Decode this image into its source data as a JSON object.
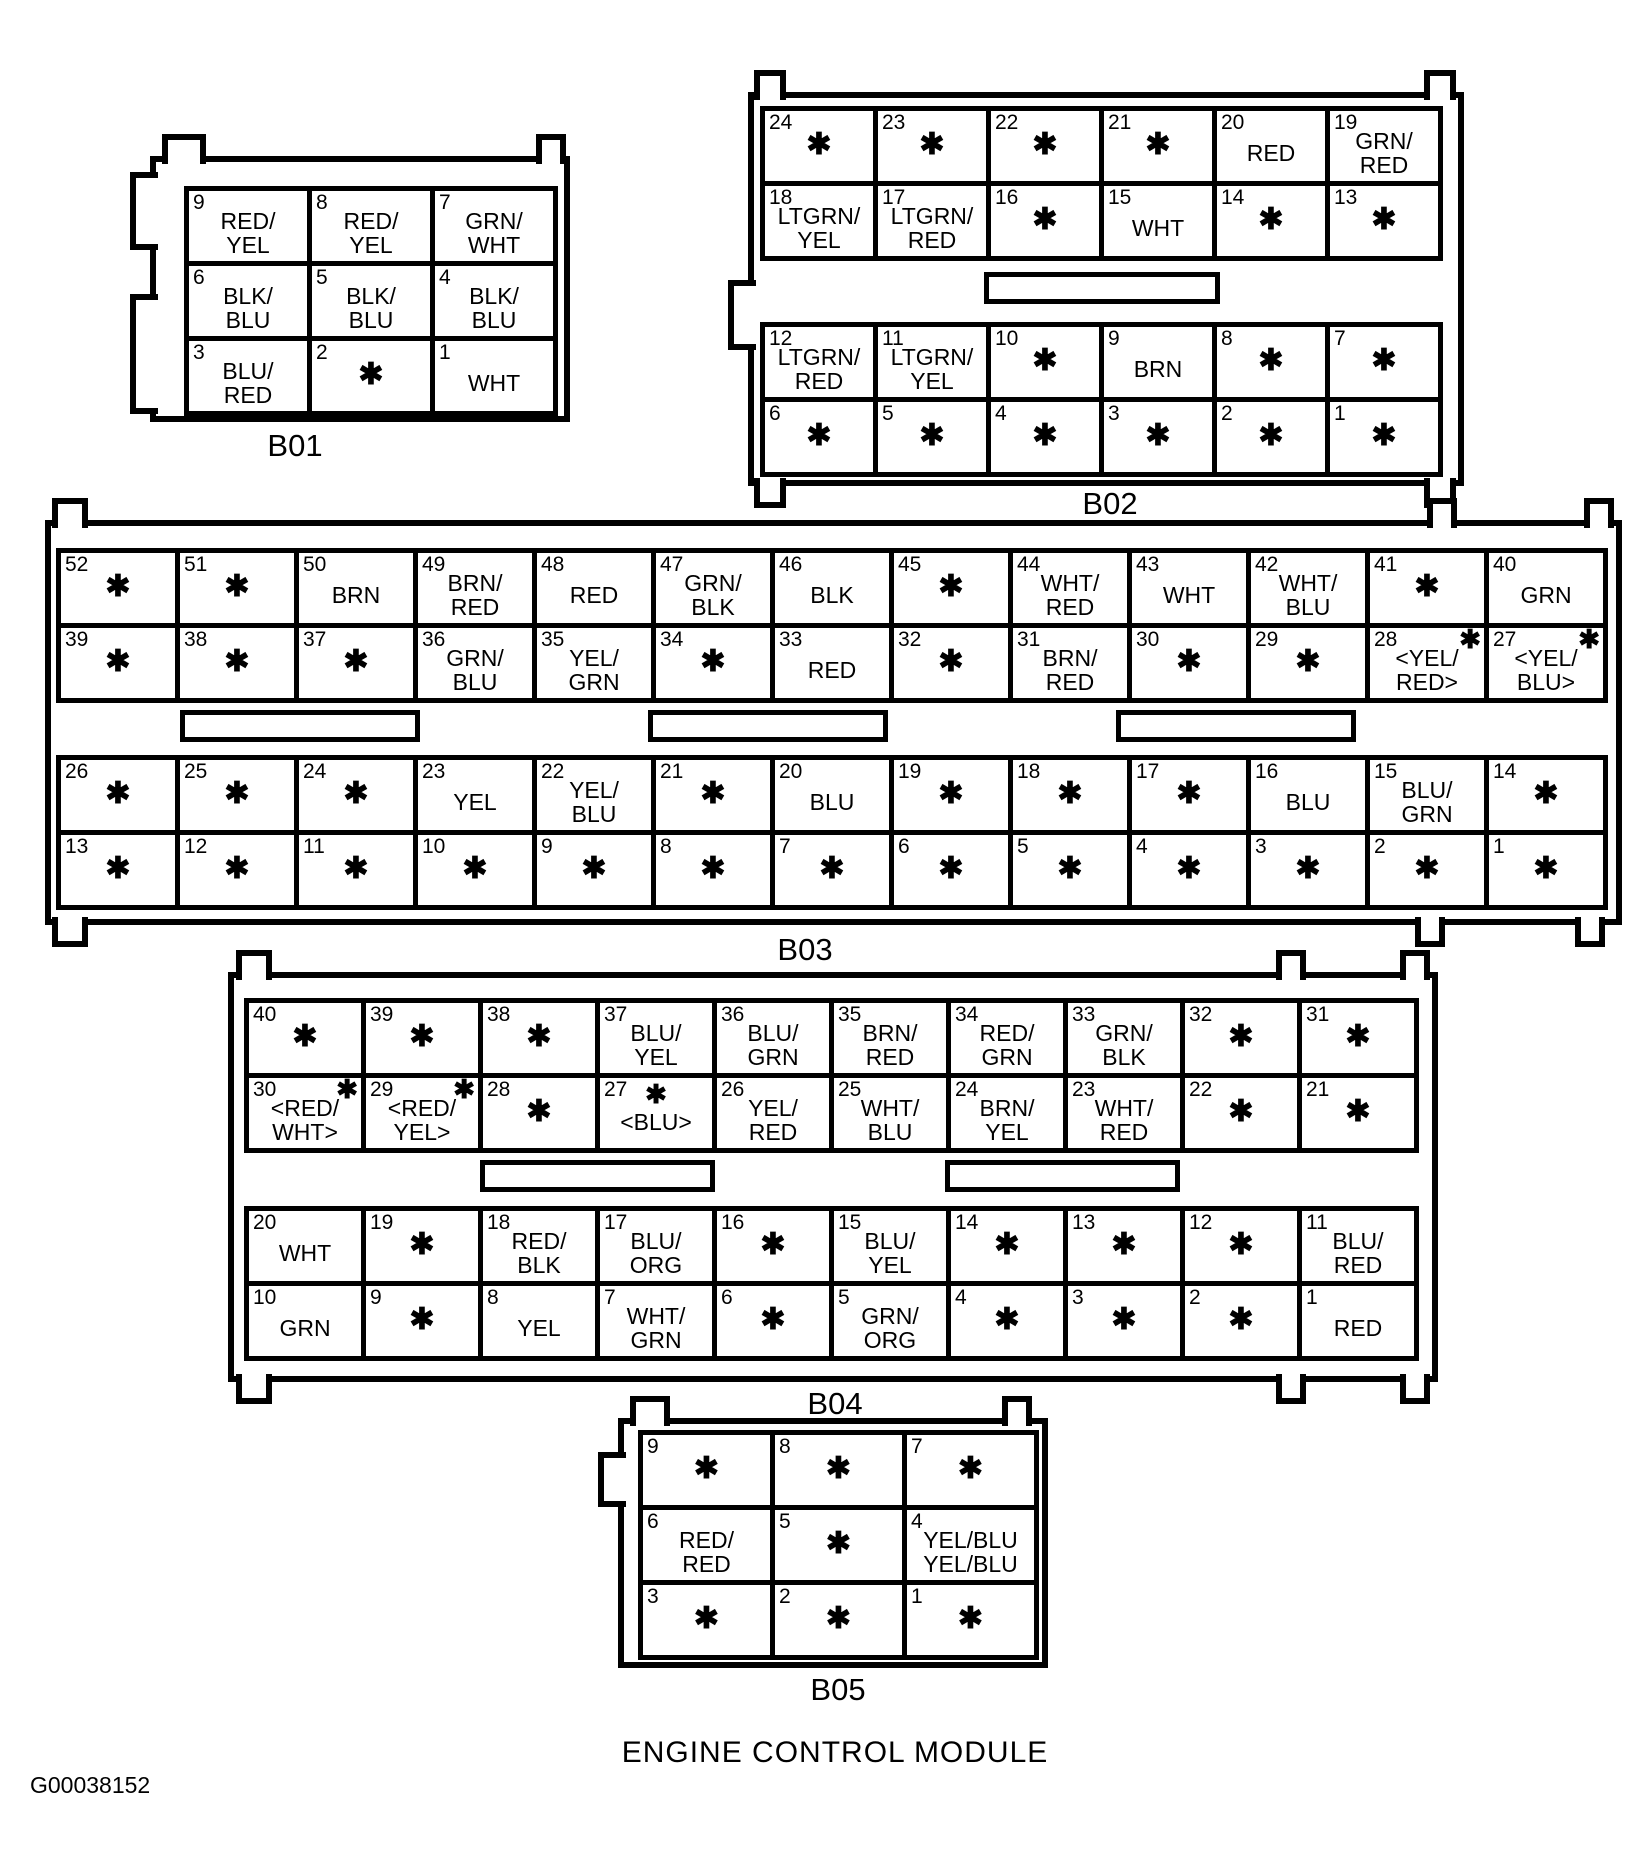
{
  "title": "ENGINE CONTROL MODULE",
  "figure_code": "G00038152",
  "star_glyph": "✱",
  "line_color": "#000000",
  "background_color": "#ffffff",
  "connectors": [
    {
      "id": "B01",
      "groups": [
        [
          [
            {
              "n": "9",
              "lines": [
                "RED/",
                "YEL"
              ]
            },
            {
              "n": "8",
              "lines": [
                "RED/",
                "YEL"
              ]
            },
            {
              "n": "7",
              "lines": [
                "GRN/",
                "WHT"
              ]
            }
          ],
          [
            {
              "n": "6",
              "lines": [
                "BLK/",
                "BLU"
              ]
            },
            {
              "n": "5",
              "lines": [
                "BLK/",
                "BLU"
              ]
            },
            {
              "n": "4",
              "lines": [
                "BLK/",
                "BLU"
              ]
            }
          ],
          [
            {
              "n": "3",
              "lines": [
                "BLU/",
                "RED"
              ]
            },
            {
              "n": "2",
              "star": true
            },
            {
              "n": "1",
              "lines": [
                "WHT"
              ]
            }
          ]
        ]
      ]
    },
    {
      "id": "B02",
      "groups": [
        [
          [
            {
              "n": "24",
              "star": true
            },
            {
              "n": "23",
              "star": true
            },
            {
              "n": "22",
              "star": true
            },
            {
              "n": "21",
              "star": true
            },
            {
              "n": "20",
              "lines": [
                "RED"
              ]
            },
            {
              "n": "19",
              "lines": [
                "GRN/",
                "RED"
              ]
            }
          ],
          [
            {
              "n": "18",
              "lines": [
                "LTGRN/",
                "YEL"
              ]
            },
            {
              "n": "17",
              "lines": [
                "LTGRN/",
                "RED"
              ]
            },
            {
              "n": "16",
              "star": true
            },
            {
              "n": "15",
              "lines": [
                "WHT"
              ]
            },
            {
              "n": "14",
              "star": true
            },
            {
              "n": "13",
              "star": true
            }
          ]
        ],
        [
          [
            {
              "n": "12",
              "lines": [
                "LTGRN/",
                "RED"
              ]
            },
            {
              "n": "11",
              "lines": [
                "LTGRN/",
                "YEL"
              ]
            },
            {
              "n": "10",
              "star": true
            },
            {
              "n": "9",
              "lines": [
                "BRN"
              ]
            },
            {
              "n": "8",
              "star": true
            },
            {
              "n": "7",
              "star": true
            }
          ],
          [
            {
              "n": "6",
              "star": true
            },
            {
              "n": "5",
              "star": true
            },
            {
              "n": "4",
              "star": true
            },
            {
              "n": "3",
              "star": true
            },
            {
              "n": "2",
              "star": true
            },
            {
              "n": "1",
              "star": true
            }
          ]
        ]
      ]
    },
    {
      "id": "B03",
      "groups": [
        [
          [
            {
              "n": "52",
              "star": true
            },
            {
              "n": "51",
              "star": true
            },
            {
              "n": "50",
              "lines": [
                "BRN"
              ]
            },
            {
              "n": "49",
              "lines": [
                "BRN/",
                "RED"
              ]
            },
            {
              "n": "48",
              "lines": [
                "RED"
              ]
            },
            {
              "n": "47",
              "lines": [
                "GRN/",
                "BLK"
              ]
            },
            {
              "n": "46",
              "lines": [
                "BLK"
              ]
            },
            {
              "n": "45",
              "star": true
            },
            {
              "n": "44",
              "lines": [
                "WHT/",
                "RED"
              ]
            },
            {
              "n": "43",
              "lines": [
                "WHT"
              ]
            },
            {
              "n": "42",
              "lines": [
                "WHT/",
                "BLU"
              ]
            },
            {
              "n": "41",
              "star": true
            },
            {
              "n": "40",
              "lines": [
                "GRN"
              ]
            }
          ],
          [
            {
              "n": "39",
              "star": true
            },
            {
              "n": "38",
              "star": true
            },
            {
              "n": "37",
              "star": true
            },
            {
              "n": "36",
              "lines": [
                "GRN/",
                "BLU"
              ]
            },
            {
              "n": "35",
              "lines": [
                "YEL/",
                "GRN"
              ]
            },
            {
              "n": "34",
              "star": true
            },
            {
              "n": "33",
              "lines": [
                "RED"
              ]
            },
            {
              "n": "32",
              "star": true
            },
            {
              "n": "31",
              "lines": [
                "BRN/",
                "RED"
              ]
            },
            {
              "n": "30",
              "star": true
            },
            {
              "n": "29",
              "star": true
            },
            {
              "n": "28",
              "lines": [
                "<YEL/",
                "RED>"
              ],
              "star": true,
              "star_pos": "corner"
            },
            {
              "n": "27",
              "lines": [
                "<YEL/",
                "BLU>"
              ],
              "star": true,
              "star_pos": "corner"
            }
          ]
        ],
        [
          [
            {
              "n": "26",
              "star": true
            },
            {
              "n": "25",
              "star": true
            },
            {
              "n": "24",
              "star": true
            },
            {
              "n": "23",
              "lines": [
                "YEL"
              ]
            },
            {
              "n": "22",
              "lines": [
                "YEL/",
                "BLU"
              ]
            },
            {
              "n": "21",
              "star": true
            },
            {
              "n": "20",
              "lines": [
                "BLU"
              ]
            },
            {
              "n": "19",
              "star": true
            },
            {
              "n": "18",
              "star": true
            },
            {
              "n": "17",
              "star": true
            },
            {
              "n": "16",
              "lines": [
                "BLU"
              ]
            },
            {
              "n": "15",
              "lines": [
                "BLU/",
                "GRN"
              ]
            },
            {
              "n": "14",
              "star": true
            }
          ],
          [
            {
              "n": "13",
              "star": true
            },
            {
              "n": "12",
              "star": true
            },
            {
              "n": "11",
              "star": true
            },
            {
              "n": "10",
              "star": true
            },
            {
              "n": "9",
              "star": true
            },
            {
              "n": "8",
              "star": true
            },
            {
              "n": "7",
              "star": true
            },
            {
              "n": "6",
              "star": true
            },
            {
              "n": "5",
              "star": true
            },
            {
              "n": "4",
              "star": true
            },
            {
              "n": "3",
              "star": true
            },
            {
              "n": "2",
              "star": true
            },
            {
              "n": "1",
              "star": true
            }
          ]
        ]
      ]
    },
    {
      "id": "B04",
      "groups": [
        [
          [
            {
              "n": "40",
              "star": true
            },
            {
              "n": "39",
              "star": true
            },
            {
              "n": "38",
              "star": true
            },
            {
              "n": "37",
              "lines": [
                "BLU/",
                "YEL"
              ]
            },
            {
              "n": "36",
              "lines": [
                "BLU/",
                "GRN"
              ]
            },
            {
              "n": "35",
              "lines": [
                "BRN/",
                "RED"
              ]
            },
            {
              "n": "34",
              "lines": [
                "RED/",
                "GRN"
              ]
            },
            {
              "n": "33",
              "lines": [
                "GRN/",
                "BLK"
              ]
            },
            {
              "n": "32",
              "star": true
            },
            {
              "n": "31",
              "star": true
            }
          ],
          [
            {
              "n": "30",
              "lines": [
                "<RED/",
                "WHT>"
              ],
              "star": true,
              "star_pos": "corner"
            },
            {
              "n": "29",
              "lines": [
                "<RED/",
                "YEL>"
              ],
              "star": true,
              "star_pos": "corner"
            },
            {
              "n": "28",
              "star": true
            },
            {
              "n": "27",
              "lines": [
                "<BLU>"
              ],
              "star": true,
              "star_pos": "mid"
            },
            {
              "n": "26",
              "lines": [
                "YEL/",
                "RED"
              ]
            },
            {
              "n": "25",
              "lines": [
                "WHT/",
                "BLU"
              ]
            },
            {
              "n": "24",
              "lines": [
                "BRN/",
                "YEL"
              ]
            },
            {
              "n": "23",
              "lines": [
                "WHT/",
                "RED"
              ]
            },
            {
              "n": "22",
              "star": true
            },
            {
              "n": "21",
              "star": true
            }
          ]
        ],
        [
          [
            {
              "n": "20",
              "lines": [
                "WHT"
              ]
            },
            {
              "n": "19",
              "star": true
            },
            {
              "n": "18",
              "lines": [
                "RED/",
                "BLK"
              ]
            },
            {
              "n": "17",
              "lines": [
                "BLU/",
                "ORG"
              ]
            },
            {
              "n": "16",
              "star": true
            },
            {
              "n": "15",
              "lines": [
                "BLU/",
                "YEL"
              ]
            },
            {
              "n": "14",
              "star": true
            },
            {
              "n": "13",
              "star": true
            },
            {
              "n": "12",
              "star": true
            },
            {
              "n": "11",
              "lines": [
                "BLU/",
                "RED"
              ]
            }
          ],
          [
            {
              "n": "10",
              "lines": [
                "GRN"
              ]
            },
            {
              "n": "9",
              "star": true
            },
            {
              "n": "8",
              "lines": [
                "YEL"
              ]
            },
            {
              "n": "7",
              "lines": [
                "WHT/",
                "GRN"
              ]
            },
            {
              "n": "6",
              "star": true
            },
            {
              "n": "5",
              "lines": [
                "GRN/",
                "ORG"
              ]
            },
            {
              "n": "4",
              "star": true
            },
            {
              "n": "3",
              "star": true
            },
            {
              "n": "2",
              "star": true
            },
            {
              "n": "1",
              "lines": [
                "RED"
              ]
            }
          ]
        ]
      ]
    },
    {
      "id": "B05",
      "groups": [
        [
          [
            {
              "n": "9",
              "star": true
            },
            {
              "n": "8",
              "star": true
            },
            {
              "n": "7",
              "star": true
            }
          ],
          [
            {
              "n": "6",
              "lines": [
                "RED/",
                "RED"
              ]
            },
            {
              "n": "5",
              "star": true
            },
            {
              "n": "4",
              "lines": [
                "YEL/BLU",
                "YEL/BLU"
              ]
            }
          ],
          [
            {
              "n": "3",
              "star": true
            },
            {
              "n": "2",
              "star": true
            },
            {
              "n": "1",
              "star": true
            }
          ]
        ]
      ]
    }
  ]
}
